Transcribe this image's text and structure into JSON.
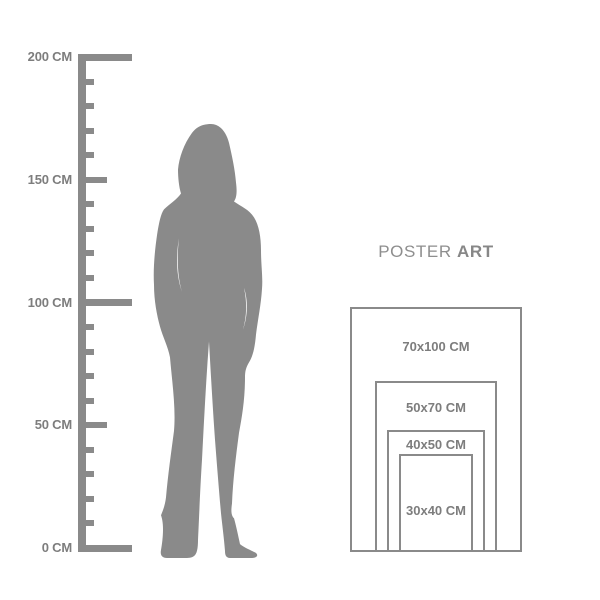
{
  "title": {
    "regular": "POSTER",
    "bold": "ART"
  },
  "ruler": {
    "unit": "CM",
    "min": 0,
    "max": 200,
    "step": 10,
    "label_every": 50,
    "labels": [
      {
        "value": 200,
        "text": "200 CM"
      },
      {
        "value": 150,
        "text": "150 CM"
      },
      {
        "value": 100,
        "text": "100 CM"
      },
      {
        "value": 50,
        "text": "50 CM"
      },
      {
        "value": 0,
        "text": "0 CM"
      }
    ]
  },
  "posters": [
    {
      "label": "70x100 CM",
      "width_cm": 70,
      "height_cm": 100
    },
    {
      "label": "50x70 CM",
      "width_cm": 50,
      "height_cm": 70
    },
    {
      "label": "40x50 CM",
      "width_cm": 40,
      "height_cm": 50
    },
    {
      "label": "30x40 CM",
      "width_cm": 30,
      "height_cm": 40
    }
  ],
  "colors": {
    "gray": "#8a8a8a",
    "text_gray": "#7d7d7d",
    "background": "#ffffff"
  }
}
